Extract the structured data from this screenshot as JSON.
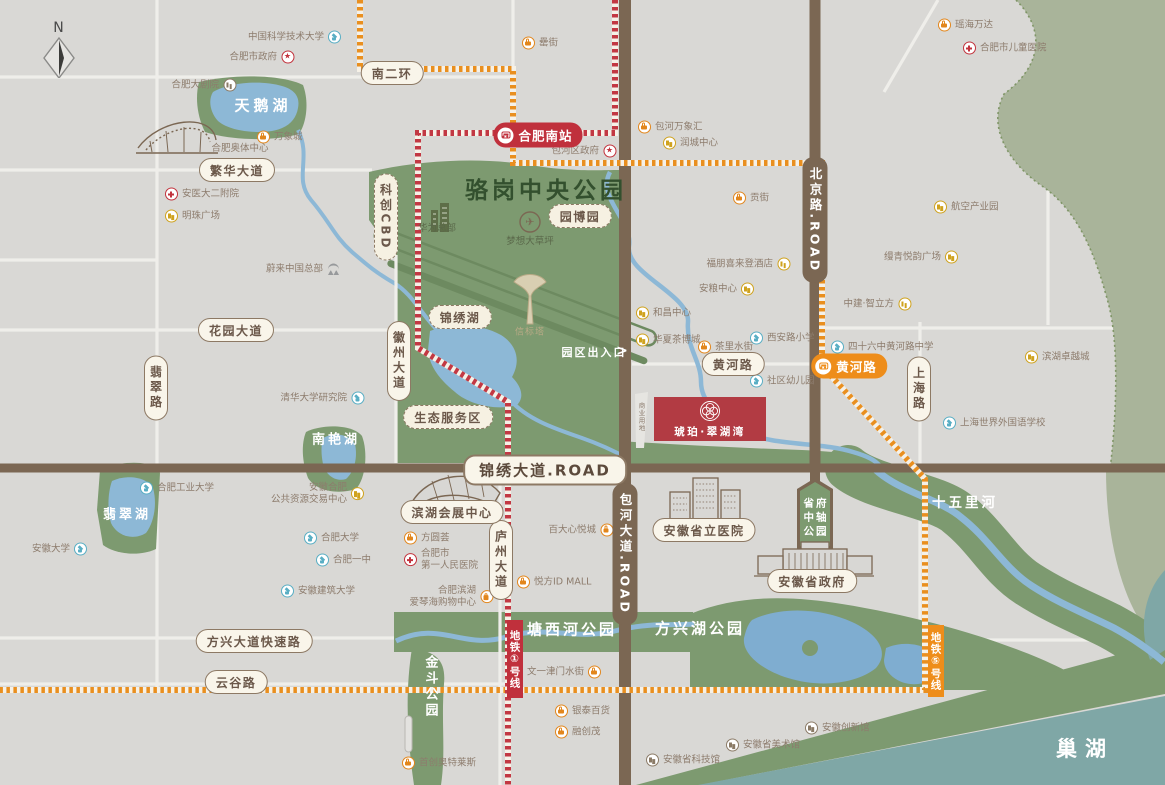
{
  "compass": {
    "label": "N"
  },
  "property": {
    "name": "琥珀·翠湖湾",
    "x": 710,
    "y": 419,
    "w": 112,
    "h": 44,
    "color": "#b23b43"
  },
  "stations": [
    {
      "label": "合肥南站",
      "x": 538,
      "y": 135,
      "color": "red"
    },
    {
      "label": "黄河路",
      "x": 849,
      "y": 366,
      "color": "orange"
    }
  ],
  "metro_banners": [
    {
      "label": "地铁①号线",
      "x": 515,
      "y": 659,
      "h": 78,
      "color": "red"
    },
    {
      "label": "地铁⑤号线",
      "x": 936,
      "y": 661,
      "h": 72,
      "color": "orange"
    }
  ],
  "road_pills": [
    {
      "label": "南二环",
      "x": 392,
      "y": 73
    },
    {
      "label": "繁华大道",
      "x": 237,
      "y": 170
    },
    {
      "label": "花园大道",
      "x": 236,
      "y": 330
    },
    {
      "label": "翡翠路",
      "x": 156,
      "y": 388,
      "v": true
    },
    {
      "label": "徽州大道",
      "x": 399,
      "y": 361,
      "v": true
    },
    {
      "label": "庐州大道",
      "x": 501,
      "y": 560,
      "v": true
    },
    {
      "label": "上海路",
      "x": 919,
      "y": 389,
      "v": true
    },
    {
      "label": "方兴大道快速路",
      "x": 254,
      "y": 641
    },
    {
      "label": "云谷路",
      "x": 236,
      "y": 682
    },
    {
      "label": "黄河路",
      "x": 733,
      "y": 364
    },
    {
      "label": "锦绣大道.ROAD",
      "x": 545,
      "y": 470,
      "big": true
    },
    {
      "label": "滨湖会展中心",
      "x": 452,
      "y": 512
    },
    {
      "label": "安徽省立医院",
      "x": 704,
      "y": 530
    },
    {
      "label": "安徽省政府",
      "x": 812,
      "y": 581
    }
  ],
  "dashed_pills": [
    {
      "label": "锦绣湖",
      "x": 460,
      "y": 317
    },
    {
      "label": "生态服务区",
      "x": 448,
      "y": 417
    },
    {
      "label": "园博园",
      "x": 580,
      "y": 216
    },
    {
      "label": "科创CBD",
      "x": 386,
      "y": 217,
      "v": true
    }
  ],
  "road_caps": [
    {
      "label": "北京路.ROAD",
      "x": 815,
      "y": 220
    },
    {
      "label": "包河大道.ROAD",
      "x": 625,
      "y": 554
    }
  ],
  "shield": {
    "x": 816,
    "lines": [
      "省府",
      "中轴",
      "公园"
    ],
    "ys": [
      503,
      517,
      531
    ]
  },
  "area_labels": [
    {
      "t": "骆岗中央公园",
      "x": 546,
      "y": 188,
      "cls": "park-title"
    },
    {
      "t": "天鹅湖",
      "x": 263,
      "y": 105,
      "cls": "lake-l"
    },
    {
      "t": "翡翠湖",
      "x": 127,
      "y": 513,
      "cls": "lake-m"
    },
    {
      "t": "南艳湖",
      "x": 336,
      "y": 438,
      "cls": "lake-m"
    },
    {
      "t": "塘西河公园",
      "x": 572,
      "y": 629,
      "cls": "park-m"
    },
    {
      "t": "方兴湖公园",
      "x": 700,
      "y": 628,
      "cls": "park-m"
    },
    {
      "t": "十五里河",
      "x": 965,
      "y": 501,
      "cls": "park-s"
    },
    {
      "t": "巢湖",
      "x": 1085,
      "y": 748,
      "cls": "lake-xl"
    },
    {
      "t": "金斗公园",
      "x": 430,
      "y": 687,
      "cls": "park-v"
    },
    {
      "t": "合肥奥体中心",
      "x": 240,
      "y": 147,
      "cls": "cap-gray"
    },
    {
      "t": "华为总部",
      "x": 437,
      "y": 227,
      "cls": "cap-green"
    },
    {
      "t": "梦想大草坪",
      "x": 530,
      "y": 240,
      "cls": "cap-green"
    },
    {
      "t": "✈",
      "x": 530,
      "y": 222,
      "cls": "plane"
    },
    {
      "t": "信标塔",
      "x": 530,
      "y": 331,
      "cls": "cap-tower"
    },
    {
      "t": "园区出入口",
      "x": 594,
      "y": 352,
      "cls": "gate"
    },
    {
      "t": ">",
      "x": 622,
      "y": 351,
      "cls": "gate-ch"
    },
    {
      "t": "商业用地",
      "x": 641,
      "y": 417,
      "cls": "tiny-v"
    }
  ],
  "pois": [
    {
      "label": "中国科学技术大学",
      "icon": "school",
      "side": "right",
      "x": 333,
      "y": 37
    },
    {
      "label": "合肥市政府",
      "icon": "gov",
      "side": "right",
      "x": 286,
      "y": 57
    },
    {
      "label": "合肥大剧院",
      "icon": "museum",
      "side": "right",
      "x": 228,
      "y": 85
    },
    {
      "label": "万象城",
      "icon": "shop",
      "side": "left",
      "x": 264,
      "y": 137
    },
    {
      "label": "安医大二附院",
      "icon": "hospital",
      "side": "left",
      "x": 172,
      "y": 194
    },
    {
      "label": "明珠广场",
      "icon": "gold",
      "side": "left",
      "x": 172,
      "y": 216
    },
    {
      "label": "蔚来中国总部",
      "icon": "nio",
      "side": "right",
      "x": 332,
      "y": 269
    },
    {
      "label": "罍街",
      "icon": "shop",
      "side": "left",
      "x": 529,
      "y": 43
    },
    {
      "label": "包河万象汇",
      "icon": "shop",
      "side": "left",
      "x": 645,
      "y": 127
    },
    {
      "label": "润城中心",
      "icon": "gold",
      "side": "left",
      "x": 670,
      "y": 143
    },
    {
      "label": "包河区政府",
      "icon": "gov",
      "side": "right",
      "x": 608,
      "y": 151
    },
    {
      "label": "瑶海万达",
      "icon": "shop",
      "side": "left",
      "x": 945,
      "y": 25
    },
    {
      "label": "合肥市儿童医院",
      "icon": "hospital",
      "side": "left",
      "x": 970,
      "y": 48
    },
    {
      "label": "贡街",
      "icon": "shop",
      "side": "left",
      "x": 740,
      "y": 198
    },
    {
      "label": "航空产业园",
      "icon": "gold",
      "side": "left",
      "x": 941,
      "y": 207
    },
    {
      "label": "缦青悦韵广场",
      "icon": "gold",
      "side": "right",
      "x": 950,
      "y": 257
    },
    {
      "label": "中建·智立方",
      "icon": "gold",
      "side": "right",
      "x": 903,
      "y": 304
    },
    {
      "label": "四十六中黄河路中学",
      "icon": "school",
      "side": "left",
      "x": 838,
      "y": 347
    },
    {
      "label": "西安路小学",
      "icon": "school",
      "side": "left",
      "x": 757,
      "y": 338
    },
    {
      "label": "社区幼儿园",
      "icon": "school",
      "side": "left",
      "x": 757,
      "y": 381
    },
    {
      "label": "滨湖卓越城",
      "icon": "gold",
      "side": "left",
      "x": 1032,
      "y": 357
    },
    {
      "label": "上海世界外国语学校",
      "icon": "school",
      "side": "left",
      "x": 950,
      "y": 423
    },
    {
      "label": "福朋喜来登酒店",
      "icon": "gold",
      "side": "right",
      "x": 782,
      "y": 264
    },
    {
      "label": "安粮中心",
      "icon": "gold",
      "side": "right",
      "x": 746,
      "y": 289
    },
    {
      "label": "和昌中心",
      "icon": "gold",
      "side": "left",
      "x": 643,
      "y": 313
    },
    {
      "label": "华夏茶博城",
      "icon": "gold",
      "side": "left",
      "x": 643,
      "y": 340
    },
    {
      "label": "茶里水街",
      "icon": "shop",
      "side": "left",
      "x": 705,
      "y": 347
    },
    {
      "label": "清华大学研究院",
      "icon": "school",
      "side": "right",
      "x": 356,
      "y": 398
    },
    {
      "label": "合肥工业大学",
      "icon": "school",
      "side": "left",
      "x": 147,
      "y": 488
    },
    {
      "label": "安徽大学",
      "icon": "school",
      "side": "right",
      "x": 79,
      "y": 549
    },
    {
      "lines": [
        "安徽合肥",
        "公共资源交易中心"
      ],
      "icon": "gold",
      "side": "right",
      "x": 356,
      "y": 494
    },
    {
      "label": "合肥大学",
      "icon": "school",
      "side": "left",
      "x": 311,
      "y": 538
    },
    {
      "label": "合肥一中",
      "icon": "school",
      "side": "left",
      "x": 323,
      "y": 560
    },
    {
      "label": "安徽建筑大学",
      "icon": "school",
      "side": "left",
      "x": 288,
      "y": 591
    },
    {
      "label": "方圆荟",
      "icon": "shop",
      "side": "left",
      "x": 411,
      "y": 538
    },
    {
      "lines": [
        "合肥市",
        "第一人民医院"
      ],
      "icon": "hospital",
      "side": "left",
      "x": 411,
      "y": 560
    },
    {
      "label": "百大心悦城",
      "icon": "shop",
      "side": "right",
      "x": 605,
      "y": 530
    },
    {
      "label": "悦方ID MALL",
      "icon": "shop",
      "side": "left",
      "x": 524,
      "y": 582
    },
    {
      "lines": [
        "合肥滨湖",
        "爱琴海购物中心"
      ],
      "icon": "shop",
      "side": "right",
      "x": 485,
      "y": 597
    },
    {
      "label": "文一津门水街",
      "icon": "shop",
      "side": "right",
      "x": 593,
      "y": 672
    },
    {
      "label": "银泰百货",
      "icon": "shop",
      "side": "left",
      "x": 562,
      "y": 711
    },
    {
      "label": "融创茂",
      "icon": "shop",
      "side": "left",
      "x": 562,
      "y": 732
    },
    {
      "label": "安徽省科技馆",
      "icon": "museum",
      "side": "left",
      "x": 653,
      "y": 760
    },
    {
      "label": "安徽省美术馆",
      "icon": "museum",
      "side": "left",
      "x": 733,
      "y": 745
    },
    {
      "label": "安徽创新馆",
      "icon": "museum",
      "side": "left",
      "x": 812,
      "y": 728
    },
    {
      "label": "首创奥特莱斯",
      "icon": "shop",
      "side": "left",
      "x": 409,
      "y": 763
    }
  ]
}
